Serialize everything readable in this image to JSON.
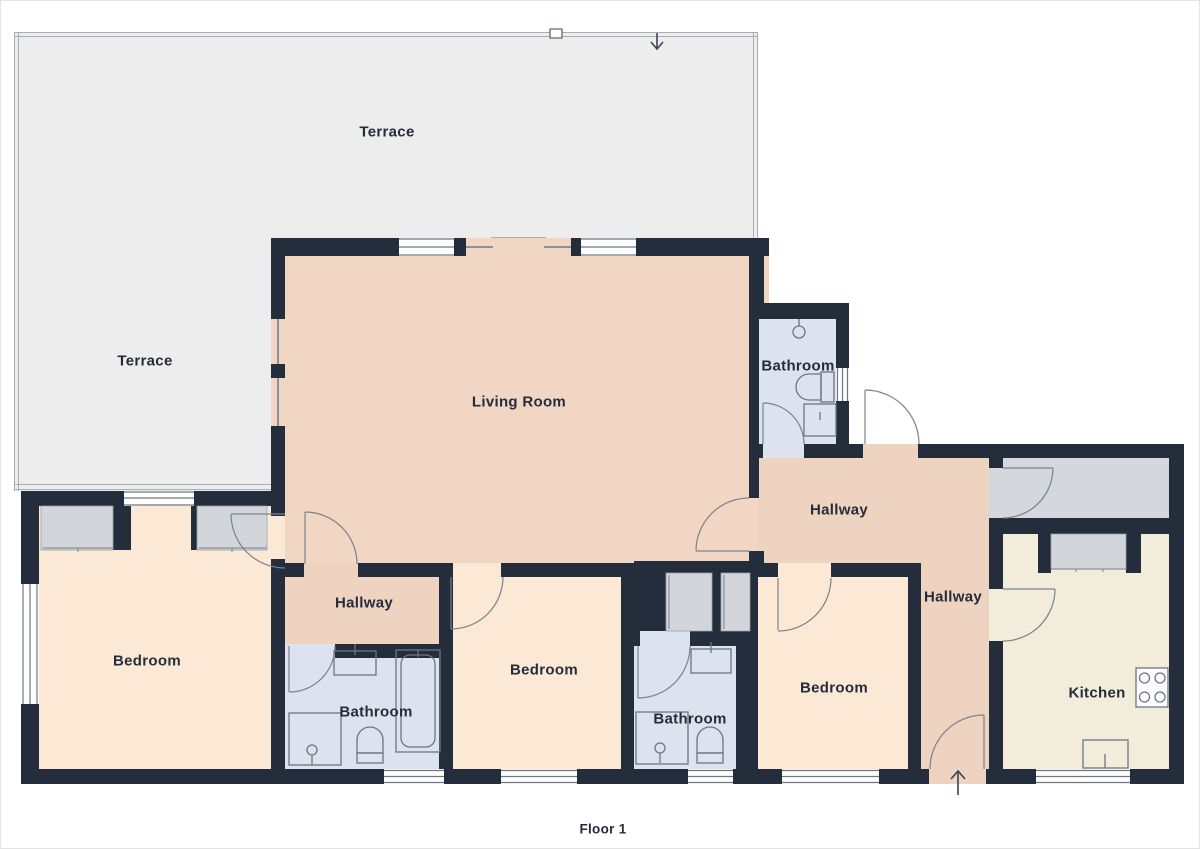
{
  "rooms": {
    "terrace_top": {
      "label": "Terrace"
    },
    "terrace_left": {
      "label": "Terrace"
    },
    "living_room": {
      "label": "Living Room"
    },
    "bathroom_top": {
      "label": "Bathroom"
    },
    "bathroom_left": {
      "label": "Bathroom"
    },
    "bathroom_center": {
      "label": "Bathroom"
    },
    "hallway_left": {
      "label": "Hallway"
    },
    "hallway_main": {
      "label": "Hallway"
    },
    "hallway_right": {
      "label": "Hallway"
    },
    "bedroom_left": {
      "label": "Bedroom"
    },
    "bedroom_center": {
      "label": "Bedroom"
    },
    "bedroom_right": {
      "label": "Bedroom"
    },
    "kitchen": {
      "label": "Kitchen"
    }
  },
  "footer": {
    "floor_label": "Floor 1"
  },
  "icons": {
    "entry_arrow": "↑",
    "terrace_arrow": "↓"
  },
  "colors": {
    "wall": "#232d3b",
    "living_room_fill": "#f1d6c4",
    "hallway_fill": "#efd3c1",
    "bedroom_fill": "#fbe9d6",
    "bathroom_fill": "#dce2ee",
    "kitchen_fill": "#f2ecda",
    "terrace_fill": "#ededee",
    "closet_fill": "#d2d5d9",
    "storage_fill": "#d4d7db",
    "fixture_outline": "#6e7582",
    "text": "#232d3b"
  }
}
